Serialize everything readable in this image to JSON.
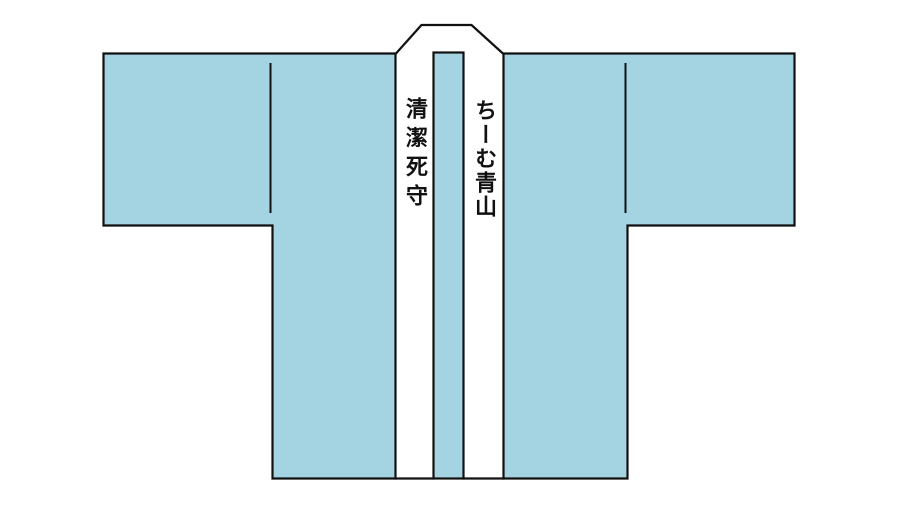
{
  "garment": {
    "type": "happi-coat",
    "left_collar_text": "清潔死守",
    "right_collar_text": "ちーむ青山"
  },
  "colors": {
    "garment_fill": "#a4d3e2",
    "outline": "#111111",
    "band_fill": "#ffffff",
    "text_color": "#111111"
  }
}
